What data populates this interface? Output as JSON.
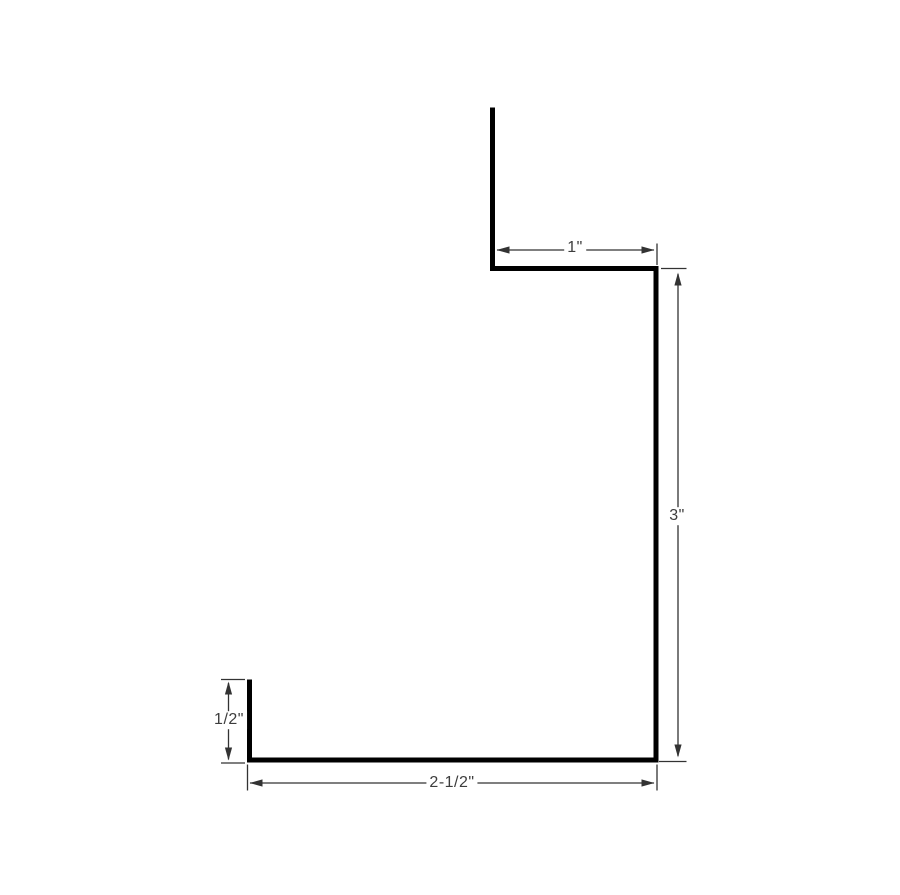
{
  "diagram_type": "dimensioned-profile-drawing",
  "colors": {
    "background": "#ffffff",
    "profile_line": "#000000",
    "dimension_line": "#333333",
    "label_text": "#3d3d3d"
  },
  "dimensions": {
    "top_width": {
      "label": "1\""
    },
    "right_height": {
      "label": "3\""
    },
    "left_leg_height": {
      "label": "1/2\""
    },
    "bottom_width": {
      "label": "2-1/2\""
    }
  }
}
